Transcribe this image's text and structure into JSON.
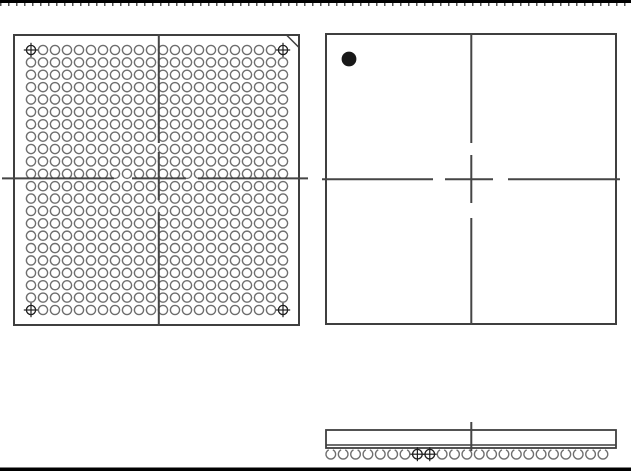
{
  "page": {
    "width": 631,
    "height": 475,
    "background": "#ffffff",
    "top_rule": {
      "y": 0,
      "height": 3,
      "color": "#000000",
      "tick_color": "#555555",
      "tick_dash": "1.5 6.5",
      "tick_y": 4.5,
      "tick_width": 3
    },
    "bottom_rule": {
      "y": 467.5,
      "height": 3.5,
      "color": "#000000"
    }
  },
  "drawing": {
    "kind": "BGA package mechanical drawing (bottom view, top view, side view)",
    "colors": {
      "outline": "#3f3f3f",
      "ball": "#6f6f6f",
      "fiducial": "#1f1f1f",
      "pin1_dot": "#181818",
      "centerline": "#454545"
    },
    "stroke": {
      "frame": 2,
      "ball": 1.4,
      "centerline": 2,
      "fiducial": 1.3,
      "chamfer": 1.5
    },
    "bottom_view": {
      "frame": {
        "x": 13,
        "y": 34,
        "width": 287,
        "height": 292
      },
      "chamfer": {
        "corner": "top-right",
        "size": 13.5
      },
      "grid": {
        "columns": 22,
        "rows": 22,
        "first_x": 31,
        "first_y": 50,
        "pitch_x": 12.0,
        "pitch_y": 12.381,
        "ball_radius": 4.6
      },
      "fiducial_cross_half": 7.2,
      "fiducial_corners": [
        "top-left",
        "top-right",
        "bottom-left",
        "bottom-right"
      ],
      "centerline_v": {
        "x": 158.8,
        "segments": [
          [
            34,
            143
          ],
          [
            152,
            200
          ],
          [
            212,
            326
          ]
        ]
      },
      "centerline_h": {
        "y": 178.4,
        "segments": [
          [
            2,
            114
          ],
          [
            132,
            186
          ],
          [
            198,
            308
          ]
        ]
      }
    },
    "top_view": {
      "frame": {
        "x": 325,
        "y": 33,
        "width": 292,
        "height": 292
      },
      "pin1_dot": {
        "cx": 349,
        "cy": 59,
        "r": 7.4
      },
      "centerline_v": {
        "x": 471.3,
        "segments": [
          [
            33,
            143
          ],
          [
            155,
            203
          ],
          [
            218,
            325
          ]
        ]
      },
      "centerline_h": {
        "y": 179.2,
        "segments": [
          [
            322,
            433
          ],
          [
            445,
            493
          ],
          [
            508,
            620
          ]
        ]
      }
    },
    "side_view": {
      "frame": {
        "x": 325,
        "y": 429,
        "width": 292,
        "height": 20
      },
      "seam_y": 445,
      "balls": {
        "count": 23,
        "first_x": 330.8,
        "pitch": 12.37,
        "cy": 454.2,
        "r": 4.8,
        "opening_half_angle_deg": 25,
        "datum_indices": [
          7,
          8
        ],
        "datum_cross_half": 7
      },
      "centerline_v": {
        "x": 471.3,
        "segments": [
          [
            422,
            451
          ]
        ]
      }
    }
  }
}
